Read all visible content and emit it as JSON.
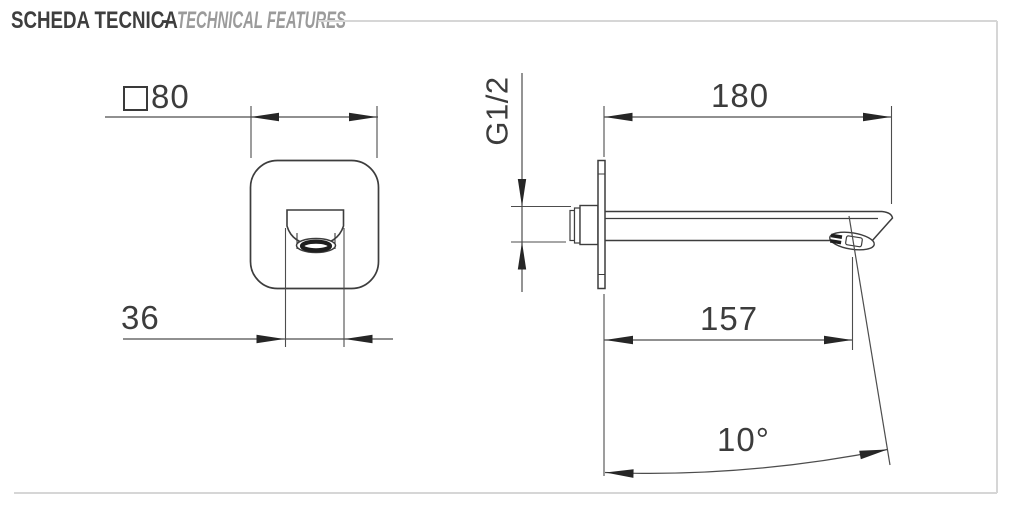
{
  "header": {
    "title_primary": "SCHEDA TECNICA",
    "separator": "-",
    "title_secondary": "TECHNICAL FEATURES"
  },
  "drawing": {
    "description": "wall-mounted spout technical dimension drawing, front view and side view",
    "front_view": {
      "view_name": "front view (wall plate with spout)",
      "plate_size": "80",
      "plate_size_prefix_icon": "square-section-icon",
      "spout_width": "36"
    },
    "side_view": {
      "view_name": "side view (spout projection)",
      "inlet_thread": "G1/2",
      "spout_length": "180",
      "outlet_projection": "157",
      "stream_angle": "10°"
    }
  },
  "icons": {
    "square_section": "square-outline (CSS bordered box, means square profile 80x80)"
  },
  "colors": {
    "background": "#ffffff",
    "object_line": "#3d3d3d",
    "dimension_line": "#4d4d4d",
    "arrow_fill": "#262626",
    "text_primary": "#3e3e3e",
    "text_secondary": "#9b9b9b",
    "frame_border": "#d6d6d6"
  }
}
